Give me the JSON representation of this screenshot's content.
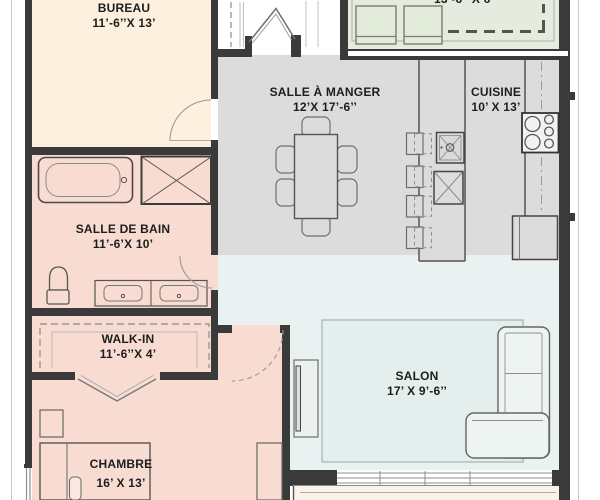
{
  "rooms": {
    "bureau": {
      "name": "BUREAU",
      "dims": "11’-6’’X 13’"
    },
    "salle_a_manger": {
      "name": "SALLE À MANGER",
      "dims": "12’X 17’-6’’"
    },
    "cuisine": {
      "name": "CUISINE",
      "dims": "10’ X 13’"
    },
    "salle_de_bain": {
      "name": "SALLE DE BAIN",
      "dims": "11’-6’X 10’"
    },
    "walk_in": {
      "name": "WALK-IN",
      "dims": "11’-6’’X 4’"
    },
    "chambre": {
      "name": "CHAMBRE",
      "dims": "16’ X 13’"
    },
    "salon": {
      "name": "SALON",
      "dims": "17’ X 9’-6’’"
    },
    "balcon": {
      "dims": "13’-6’’ X 6’"
    }
  },
  "colors": {
    "bureau": "#fdf0df",
    "chambre_zone": "#f8dcd2",
    "cuisine_manger": "#dcdcdc",
    "salon": "#e9f2f0",
    "balcon": "#e5ecdf",
    "terrasse": "#faf3e9",
    "wall": "#3a3a3a"
  },
  "furniture": [
    "bathtub",
    "linen-closet",
    "toilet",
    "double-vanity",
    "walk-in-shelves",
    "bed",
    "nightstand",
    "dresser",
    "dining-table",
    "dining-chairs",
    "kitchen-island",
    "bar-stools",
    "island-sink",
    "dishwasher",
    "cooktop",
    "refrigerator",
    "counter",
    "sectional-sofa",
    "rug",
    "tv-console",
    "balcony-chairs",
    "door-swings",
    "windows"
  ]
}
